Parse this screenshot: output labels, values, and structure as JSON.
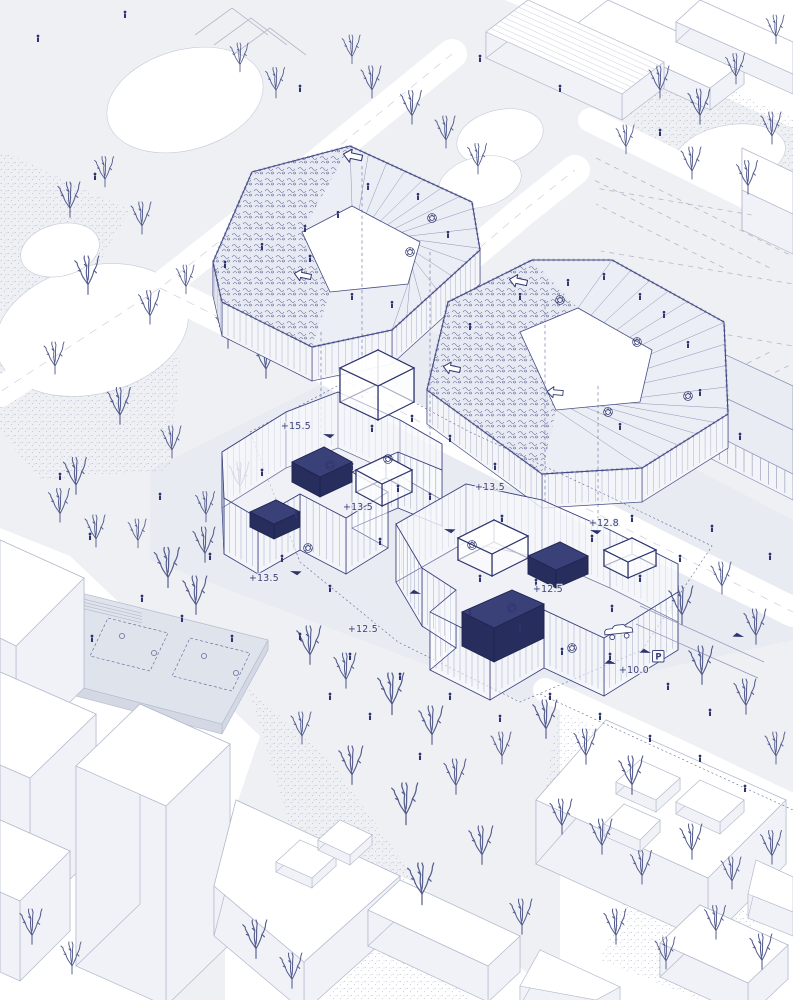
{
  "meta": {
    "title": "Axonometric architectural site drawing",
    "drawing_type": "exploded axonometric masterplan with rooftop plans, ground-floor wings, park and context buildings"
  },
  "palette": {
    "background": "#eef0f4",
    "site_ground": "#e8ebf1",
    "paper_white": "#ffffff",
    "ink_navy": "#2e356e",
    "ink_light": "#8d94b8",
    "context_line": "#b3b9cc",
    "tree": "#555d8e",
    "accent_fill": "#3a4178"
  },
  "annotations": {
    "elevation_labels": [
      {
        "text": "+15.5"
      },
      {
        "text": "+13.5"
      },
      {
        "text": "+13.5"
      },
      {
        "text": "+12.8"
      },
      {
        "text": "+13.5"
      },
      {
        "text": "+12.5"
      },
      {
        "text": "+12.5"
      },
      {
        "text": "+10.0"
      }
    ],
    "parking_sign": {
      "text": "P"
    }
  },
  "symbols": {
    "person": "pedestrian-figure",
    "tree": "bare-tree",
    "pointer": "direction-arrow",
    "hollow_arrow": "entrance-arrow",
    "stair": "spiral-stair-glyph",
    "car": "car-outline"
  }
}
